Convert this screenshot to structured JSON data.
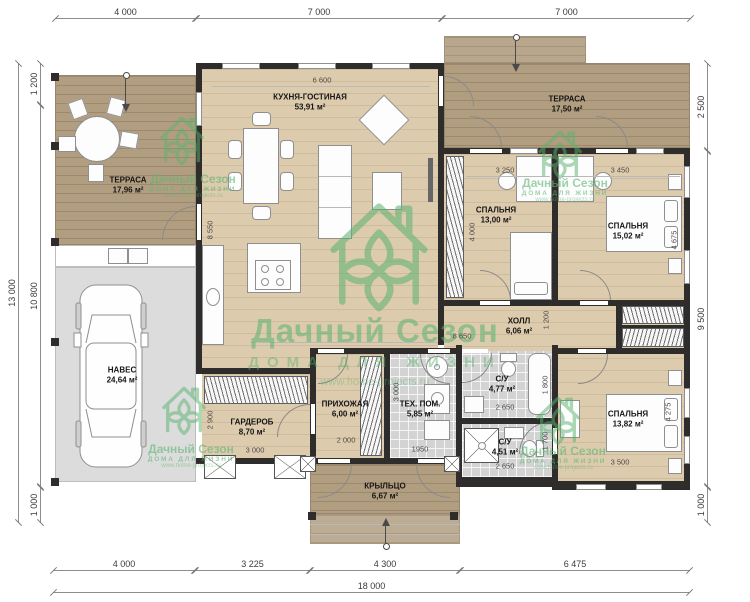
{
  "watermark": {
    "brand": "Дачный Сезон",
    "tagline": "ДОМА ДЛЯ ЖИЗНИ",
    "url": "www.home-projects.ru"
  },
  "rooms": [
    {
      "name": "ТЕРРАСА",
      "area": "17,96 м²"
    },
    {
      "name": "КУХНЯ-ГОСТИНАЯ",
      "area": "53,91 м²"
    },
    {
      "name": "ТЕРРАСА",
      "area": "17,50 м²"
    },
    {
      "name": "СПАЛЬНЯ",
      "area": "13,00 м²"
    },
    {
      "name": "СПАЛЬНЯ",
      "area": "15,02 м²"
    },
    {
      "name": "НАВЕС",
      "area": "24,64 м²"
    },
    {
      "name": "ХОЛЛ",
      "area": "6,06 м²"
    },
    {
      "name": "С/У",
      "area": "4,77 м²"
    },
    {
      "name": "ГАРДЕРОБ",
      "area": "8,70 м²"
    },
    {
      "name": "ПРИХОЖАЯ",
      "area": "6,00 м²"
    },
    {
      "name": "ТЕХ. ПОМ.",
      "area": "5,85 м²"
    },
    {
      "name": "С/У",
      "area": "4,51 м²"
    },
    {
      "name": "СПАЛЬНЯ",
      "area": "13,82 м²"
    },
    {
      "name": "КРЫЛЬЦО",
      "area": "6,67 м²"
    }
  ],
  "dimensions": {
    "top": [
      "4 000",
      "7 000",
      "7 000"
    ],
    "bottom": [
      "4 000",
      "3 225",
      "4 300",
      "6 475"
    ],
    "bottom_total": "18 000",
    "left_total": "13 000",
    "left": [
      "1 200",
      "10 800",
      "1 000"
    ],
    "right": [
      "2 500",
      "9 500",
      "1 000"
    ],
    "interior": {
      "kitchen_top": "6 600",
      "kitchen_left": "8 550",
      "bed1_w": "3 250",
      "bed1_h": "4 000",
      "bed2_w": "3 450",
      "bed2_h": "4 675",
      "hall_w": "8 650",
      "hall_h": "1 200",
      "wc1_h": "1 800",
      "wc1_w": "2 650",
      "wc2_w": "2 650",
      "wc2_h": "1 700",
      "tech_h": "3 000",
      "tech_w": "1950",
      "entry_w": "2 000",
      "ward_h": "2 900",
      "ward_w": "3 000",
      "bed3_w": "3 500",
      "bed3_h": "4 275"
    }
  },
  "colors": {
    "wall": "#2e2d2b",
    "wood_floor": "#ddcbae",
    "terrace_wood": "#b19e81",
    "carport_grey": "#dcdcdc",
    "tile_grey": "#d3d3d3",
    "watermark_green": "#58b26d"
  }
}
